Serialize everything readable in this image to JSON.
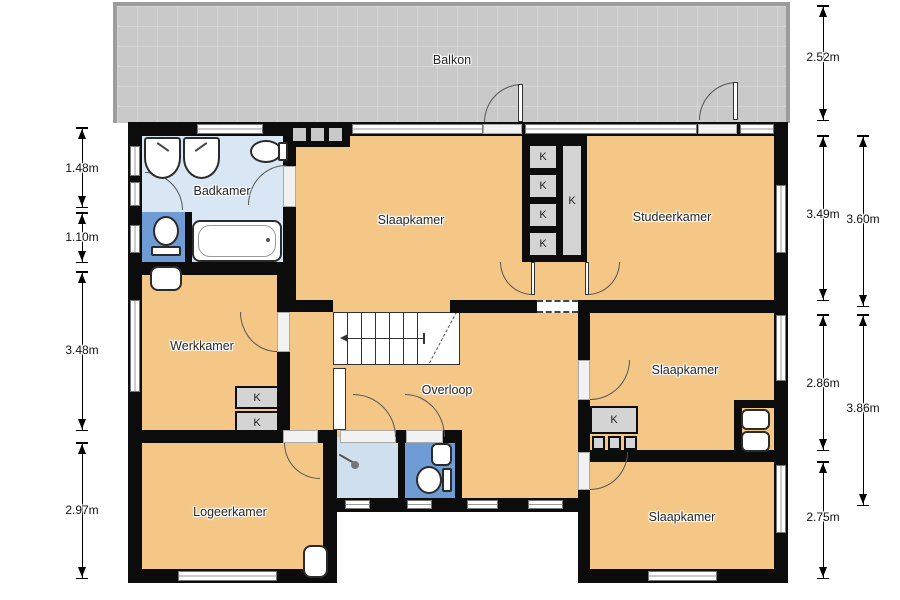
{
  "floorplan": {
    "title": "Dutch first-floor floorplan",
    "rooms": {
      "balkon": {
        "label": "Balkon"
      },
      "badkamer": {
        "label": "Badkamer"
      },
      "slaapkamer_top": {
        "label": "Slaapkamer"
      },
      "studeerkamer": {
        "label": "Studeerkamer"
      },
      "werkkamer": {
        "label": "Werkkamer"
      },
      "overloop": {
        "label": "Overloop"
      },
      "slaapkamer_mid": {
        "label": "Slaapkamer"
      },
      "logeerkamer": {
        "label": "Logeerkamer"
      },
      "slaapkamer_bottom": {
        "label": "Slaapkamer"
      }
    },
    "closets": {
      "k": "K"
    },
    "dimensions": {
      "left": [
        "1.48m",
        "1.10m",
        "3.48m",
        "2.97m"
      ],
      "right_inner": [
        "2.52m",
        "3.49m",
        "2.86m",
        "2.75m"
      ],
      "right_outer": [
        "3.60m",
        "3.86m"
      ]
    },
    "fixtures": [
      "sink-icon",
      "toilet-icon",
      "bathtub-icon",
      "shower-icon",
      "stairs-icon"
    ],
    "colors": {
      "floor": "#f4c787",
      "balcony": "#c9c9c9",
      "bathroom_light_blue": "#d9e6f4",
      "shower_light_blue": "#cfdfee",
      "wc_blue": "#6f9cd4",
      "wall": "#0c0c0c",
      "closet_gray": "#d4d4d4"
    }
  }
}
